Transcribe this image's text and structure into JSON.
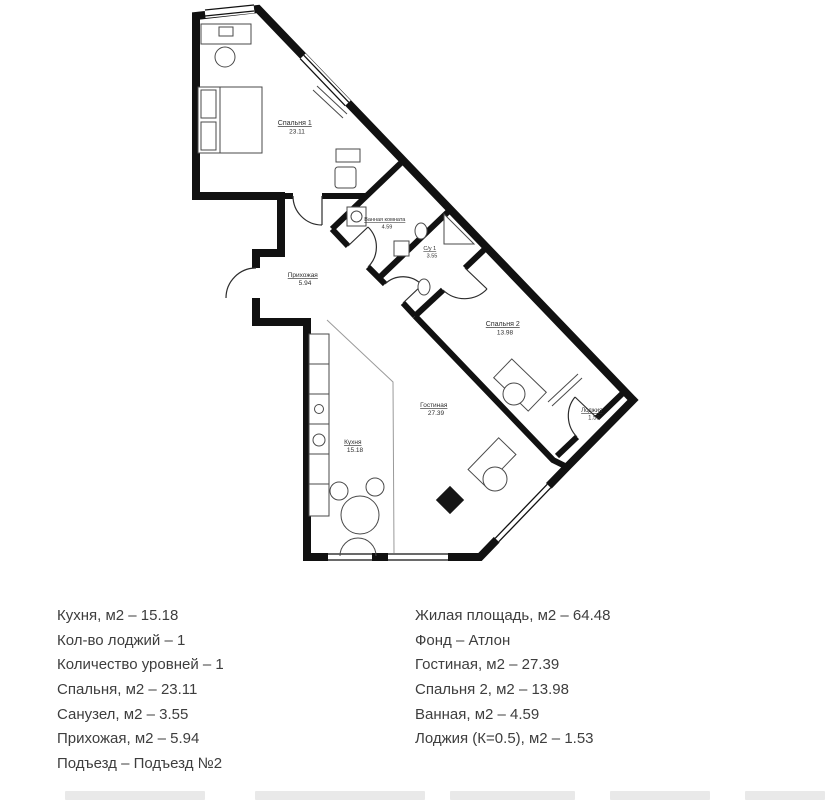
{
  "plan": {
    "rooms": [
      {
        "name": "Спальня 1",
        "area": "23.11"
      },
      {
        "name": "Ванная комната",
        "area": "4.59"
      },
      {
        "name": "С/у 1",
        "area": "3.55"
      },
      {
        "name": "Прихожая",
        "area": "5.94"
      },
      {
        "name": "Спальня 2",
        "area": "13.98"
      },
      {
        "name": "Лоджия",
        "area": "1.53"
      },
      {
        "name": "Гостиная",
        "area": "27.39"
      },
      {
        "name": "Кухня",
        "area": "15.18"
      }
    ]
  },
  "details": {
    "left_column": [
      "Кухня, м2 – 15.18",
      "Кол-во лоджий – 1",
      "Количество уровней – 1",
      "Спальня, м2 – 23.11",
      "Санузел, м2 – 3.55",
      "Прихожая, м2 – 5.94",
      "Подъезд – Подъезд №2"
    ],
    "right_column": [
      "Жилая площадь, м2 – 64.48",
      "Фонд – Атлон",
      "Гостиная, м2 – 27.39",
      "Спальня 2, м2 – 13.98",
      "Ванная, м2 – 4.59",
      "Лоджия (К=0.5), м2 – 1.53"
    ]
  },
  "colors": {
    "wall": "#111111",
    "text": "#3e3e3e",
    "furniture": "#4a4a4a"
  }
}
